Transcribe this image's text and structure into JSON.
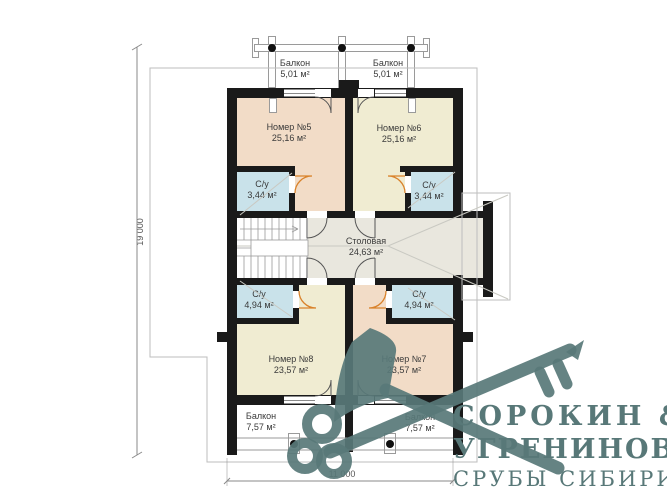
{
  "plan": {
    "title": "floor-plan-second-storey",
    "dimensions": {
      "vertical": "19 000",
      "horizontal": "11 000"
    },
    "rooms": [
      {
        "id": "room5",
        "name": "Номер №5",
        "area": "25,16 м²"
      },
      {
        "id": "room6",
        "name": "Номер №6",
        "area": "25,16 м²"
      },
      {
        "id": "wc-top-left",
        "name": "С/у",
        "area": "3,44 м²"
      },
      {
        "id": "wc-top-right",
        "name": "С/у",
        "area": "3,44 м²"
      },
      {
        "id": "dining",
        "name": "Столовая",
        "area": "24,63 м²"
      },
      {
        "id": "wc-bottom-left",
        "name": "С/у",
        "area": "4,94 м²"
      },
      {
        "id": "wc-bottom-right",
        "name": "С/у",
        "area": "4,94 м²"
      },
      {
        "id": "room8",
        "name": "Номер №8",
        "area": "23,57 м²"
      },
      {
        "id": "room7",
        "name": "Номер №7",
        "area": "23,57 м²"
      },
      {
        "id": "balcony-top-left",
        "name": "Балкон",
        "area": "5,01 м²"
      },
      {
        "id": "balcony-top-right",
        "name": "Балкон",
        "area": "5,01 м²"
      },
      {
        "id": "balcony-bottom-left",
        "name": "Балкон",
        "area": "7,57 м²"
      },
      {
        "id": "balcony-bottom-right",
        "name": "Балкон",
        "area": "7,57 м²"
      }
    ],
    "colors": {
      "wall": "#1a1a1a",
      "peach": "#f2dcc7",
      "cream": "#f0ecd2",
      "blue": "#c9e2ea",
      "gray": "#e9e7de",
      "orange": "#d9822b",
      "outline": "#bdbdbd",
      "slate": "#587878"
    }
  },
  "watermark": {
    "icon": "crossed-axe-and-key-icon",
    "color": "#587878"
  },
  "logo": {
    "line1": "СОРОКИН &",
    "line2": "УГРЕНИНОВ",
    "line3": "СРУБЫ СИБИРИ"
  }
}
